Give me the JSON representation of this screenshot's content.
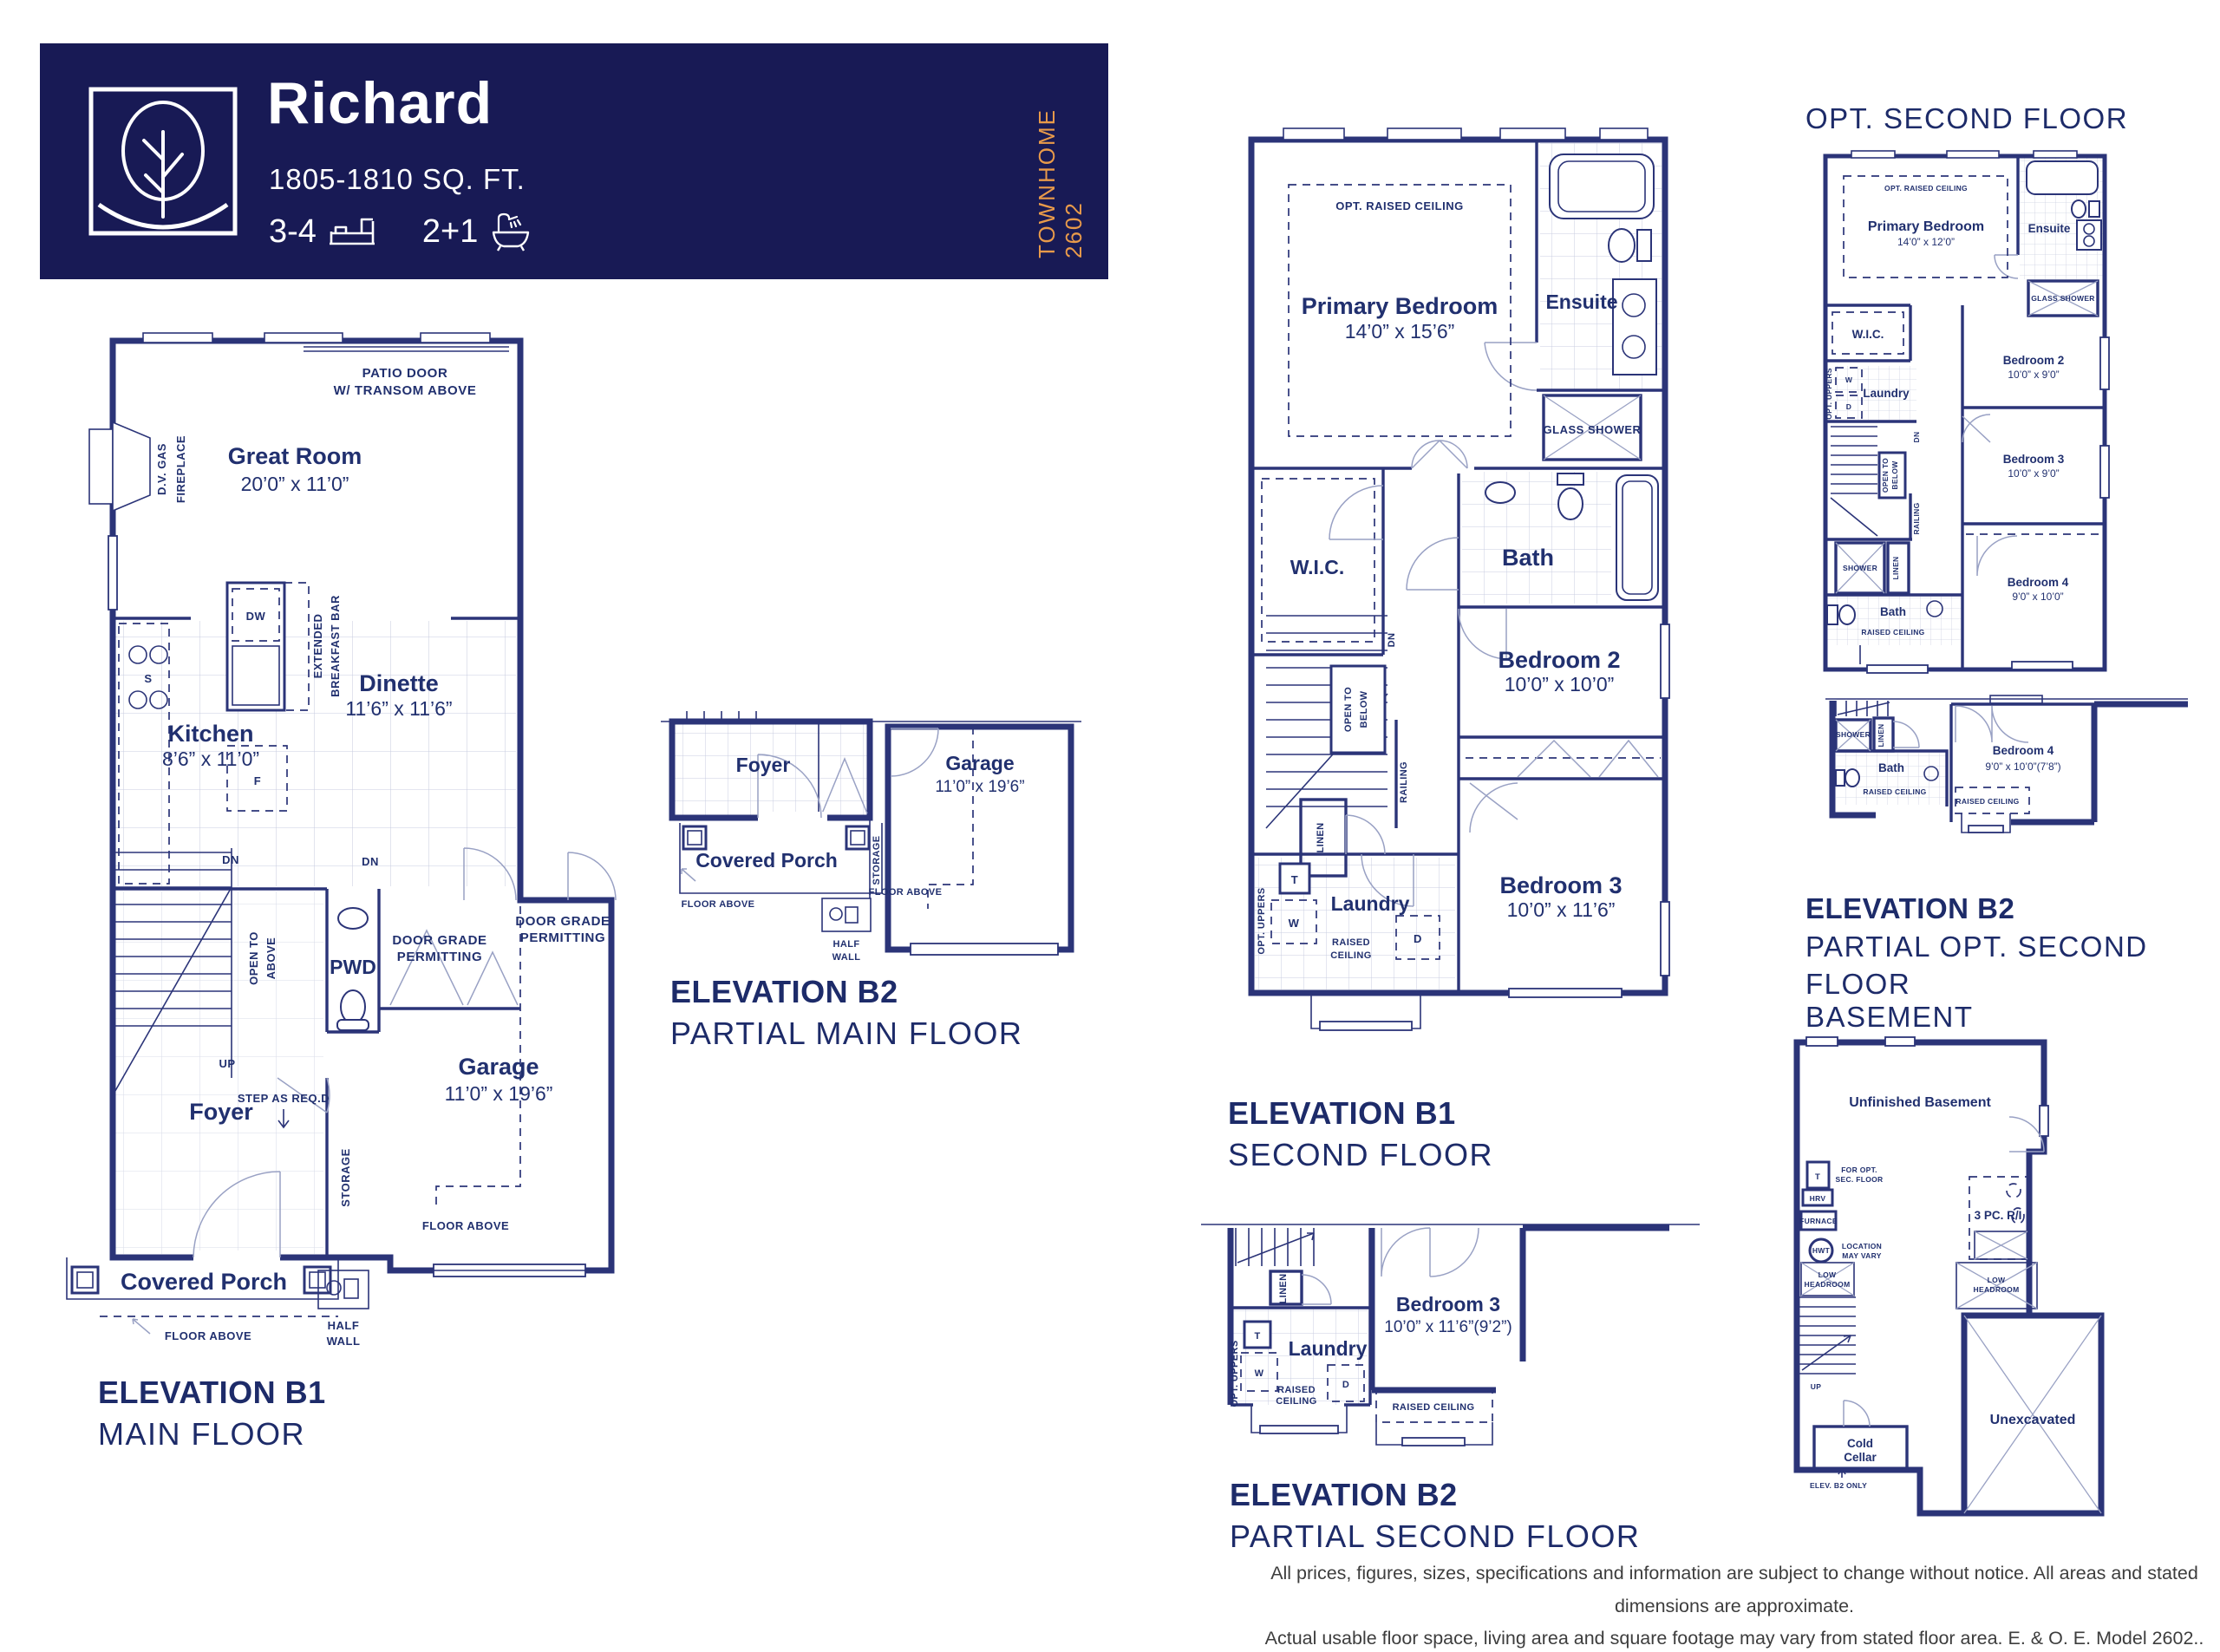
{
  "header": {
    "title": "Richard",
    "sqft": "1805-1810 SQ. FT.",
    "beds": "3-4",
    "baths": "2+1",
    "side_label": "TOWNHOME 2602",
    "colors": {
      "bg": "#181a55",
      "accent": "#e89a4a",
      "text": "#ffffff"
    }
  },
  "colors": {
    "wall": "#2b3478",
    "label": "#21306f",
    "thin": "#99a1c4"
  },
  "plans": {
    "main_b1": {
      "title": "ELEVATION B1",
      "subtitle": "MAIN FLOOR",
      "labels": {
        "patio_l1": "PATIO DOOR",
        "patio_l2": "W/ TRANSOM ABOVE",
        "fire_l1": "D.V. GAS",
        "fire_l2": "FIREPLACE",
        "great": "Great Room",
        "great_dim": "20’0” x 11’0”",
        "dw": "DW",
        "bar_l1": "EXTENDED",
        "bar_l2": "BREAKFAST BAR",
        "s": "S",
        "f": "F",
        "kitchen": "Kitchen",
        "kitchen_dim": "8’6” x 11’0”",
        "dinette": "Dinette",
        "dinette_dim": "11’6” x 11’6”",
        "dn1": "DN",
        "dn2": "DN",
        "open_l1": "OPEN TO",
        "open_l2": "ABOVE",
        "up": "UP",
        "step": "STEP AS REQ.D",
        "pwd": "PWD",
        "grade1_l1": "DOOR GRADE",
        "grade1_l2": "PERMITTING",
        "grade2_l1": "DOOR GRADE",
        "grade2_l2": "PERMITTING",
        "foyer": "Foyer",
        "garage": "Garage",
        "garage_dim": "11’0” x 19’6”",
        "porch": "Covered Porch",
        "storage": "STORAGE",
        "floor_above1": "FLOOR ABOVE",
        "floor_above2": "FLOOR ABOVE",
        "half_l1": "HALF",
        "half_l2": "WALL"
      }
    },
    "main_b2": {
      "title": "ELEVATION B2",
      "subtitle": "PARTIAL MAIN FLOOR",
      "labels": {
        "foyer": "Foyer",
        "garage": "Garage",
        "garage_dim": "11’0” x 19’6”",
        "porch": "Covered Porch",
        "storage": "STORAGE",
        "floor_above1": "FLOOR ABOVE",
        "floor_above2": "FLOOR ABOVE",
        "half_l1": "HALF",
        "half_l2": "WALL"
      }
    },
    "second_b1": {
      "title": "ELEVATION B1",
      "subtitle": "SECOND FLOOR",
      "labels": {
        "opt_ceiling": "OPT. RAISED CEILING",
        "primary": "Primary Bedroom",
        "primary_dim": "14’0” x 15’6”",
        "ensuite": "Ensuite",
        "glass_shower": "GLASS SHOWER",
        "wic": "W.I.C.",
        "bath": "Bath",
        "bed2": "Bedroom 2",
        "bed2_dim": "10’0” x 10’0”",
        "bed3": "Bedroom 3",
        "bed3_dim": "10’0” x 11’6”",
        "dn": "DN",
        "open_l1": "OPEN TO",
        "open_l2": "BELOW",
        "railing": "RAILING",
        "linen": "LINEN",
        "uppers": "OPT. UPPERS",
        "t": "T",
        "w": "W",
        "d": "D",
        "laundry": "Laundry",
        "raised_l1": "RAISED",
        "raised_l2": "CEILING"
      }
    },
    "second_b2": {
      "title": "ELEVATION B2",
      "subtitle": "PARTIAL SECOND FLOOR",
      "labels": {
        "linen": "LINEN",
        "uppers": "OPT. UPPERS",
        "t": "T",
        "w": "W",
        "d": "D",
        "laundry": "Laundry",
        "raised_l1": "RAISED",
        "raised_l2": "CEILING",
        "raised2": "RAISED CEILING",
        "bed3": "Bedroom 3",
        "bed3_dim": "10’0” x 11’6”(9’2”)"
      }
    },
    "opt2": {
      "heading": "OPT. SECOND FLOOR",
      "labels": {
        "opt_ceiling": "OPT. RAISED CEILING",
        "primary": "Primary Bedroom",
        "primary_dim": "14’0” x 12’0”",
        "ensuite": "Ensuite",
        "glass_shower": "GLASS SHOWER",
        "wic": "W.I.C.",
        "laundry": "Laundry",
        "uppers": "OPT. UPPERS",
        "w": "W",
        "d": "D",
        "dn": "DN",
        "open_l1": "OPEN TO",
        "open_l2": "BELOW",
        "railing": "RAILING",
        "bed2": "Bedroom 2",
        "bed2_dim": "10’0” x 9’0”",
        "bed3": "Bedroom 3",
        "bed3_dim": "10’0” x 9’0”",
        "shower": "SHOWER",
        "linen": "LINEN",
        "bath": "Bath",
        "raised": "RAISED CEILING",
        "bed4": "Bedroom 4",
        "bed4_dim": "9’0” x 10’0”"
      }
    },
    "opt2_b2": {
      "title": "ELEVATION B2",
      "subtitle": "PARTIAL OPT. SECOND FLOOR",
      "labels": {
        "shower": "SHOWER",
        "linen": "LINEN",
        "bath": "Bath",
        "raised1": "RAISED CEILING",
        "raised2": "RAISED CEILING",
        "bed4": "Bedroom 4",
        "bed4_dim": "9’0” x 10’0”(7’8”)"
      }
    },
    "basement": {
      "heading": "BASEMENT",
      "labels": {
        "unfinished": "Unfinished Basement",
        "t": "T",
        "for_opt_l1": "FOR OPT.",
        "for_opt_l2": "SEC. FLOOR",
        "hrv": "HRV",
        "furnace": "FURNACE",
        "hwt": "HWT",
        "loc_l1": "LOCATION",
        "loc_l2": "MAY VARY",
        "low1_l1": "LOW",
        "low1_l2": "HEADROOM",
        "low2_l1": "LOW",
        "low2_l2": "HEADROOM",
        "three_pc": "3 PC. R/I",
        "up": "UP",
        "cold_l1": "Cold",
        "cold_l2": "Cellar",
        "elev_note": "ELEV. B2 ONLY",
        "unex": "Unexcavated"
      }
    }
  },
  "disclaimer": {
    "line1": "All prices, figures, sizes, specifications and information are subject to change without notice. All areas and stated dimensions are approximate.",
    "line2": "Actual usable floor space, living area and square footage may vary from stated floor area. E. & O. E. Model 2602.."
  }
}
